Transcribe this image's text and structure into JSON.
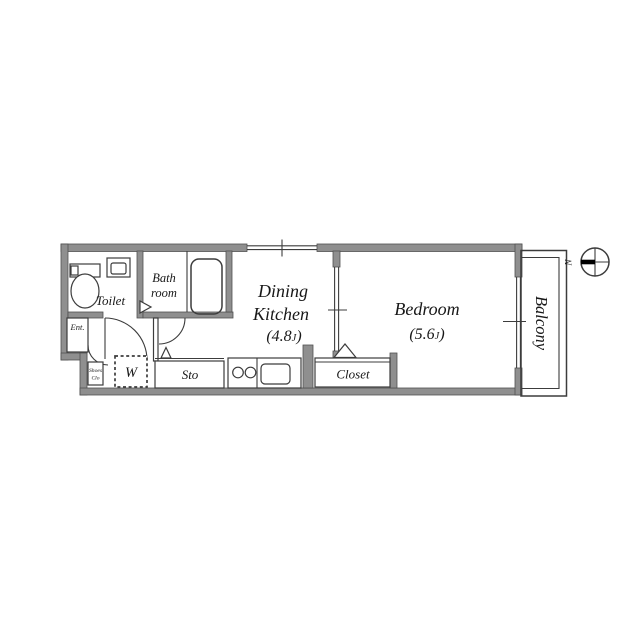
{
  "plan": {
    "rooms": {
      "toilet": {
        "label": "Toilet"
      },
      "bathroom": {
        "line1": "Bath",
        "line2": "room"
      },
      "entrance": {
        "label": "Ent."
      },
      "shoes_closet": {
        "line1": "Shoes",
        "line2": "Clo"
      },
      "washer": {
        "label": "W"
      },
      "storage": {
        "label": "Sto"
      },
      "dining_kitchen": {
        "line1": "Dining",
        "line2": "Kitchen",
        "size_open": "(4.8",
        "size_unit": "J",
        "size_close": ")"
      },
      "bedroom": {
        "label": "Bedroom",
        "size_open": "(5.6",
        "size_unit": "J",
        "size_close": ")"
      },
      "closet": {
        "label": "Closet"
      },
      "balcony": {
        "label": "Balcony"
      }
    },
    "compass": {
      "north_label": "N"
    },
    "colors": {
      "wall_fill": "#8f8f8f",
      "wall_outline": "#505050",
      "line": "#3c3c3c",
      "text": "#181818",
      "background": "#ffffff",
      "compass_north_bar": "#000000"
    }
  }
}
